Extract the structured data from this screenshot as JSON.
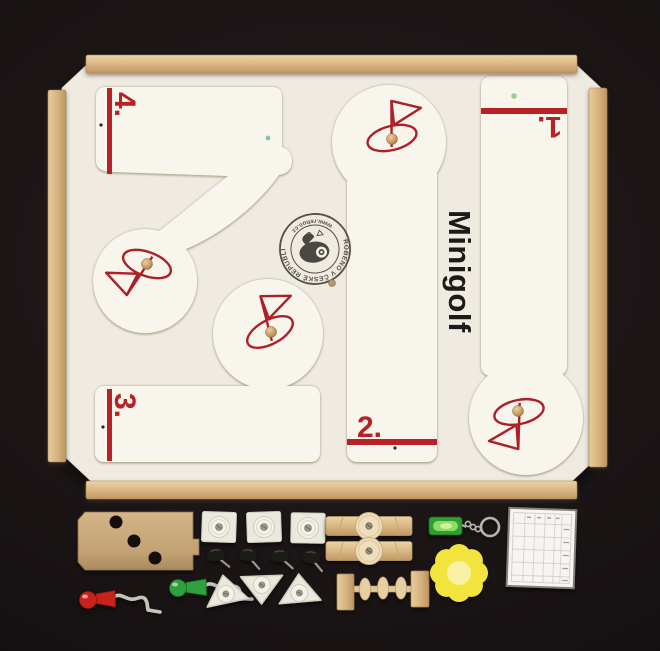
{
  "title": "Minigolf",
  "holes": {
    "h1": "1.",
    "h2": "2.",
    "h3": "3.",
    "h4": "4."
  },
  "stamp": {
    "made_in": "VYROBENO V ČESKÉ REPUBLICE",
    "website": "www.rehos.cz"
  },
  "colors": {
    "background": "#131011",
    "board": "#efebe1",
    "course": "#f8f5ed",
    "wood": "#d9b685",
    "red": "#b82226",
    "ink": "#1c1b19",
    "piece_white": "#ebe8dd",
    "piece_black": "#1d1a18",
    "club_red": "#c8241f",
    "club_green": "#2fa03c",
    "keychain_green": "#2f9e35",
    "flower_yellow": "#f3e43c",
    "mdf": "#c9aa7b",
    "ball": "#c59a5f",
    "scorecard": "#f6f5f1"
  }
}
